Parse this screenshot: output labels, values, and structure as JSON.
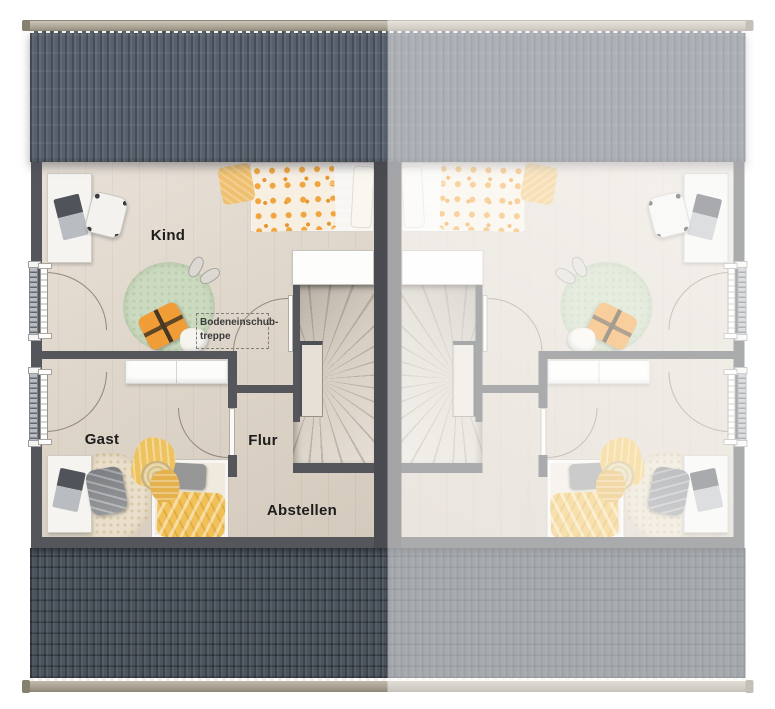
{
  "rooms": {
    "kind": "Kind",
    "gast": "Gast",
    "flur": "Flur",
    "abstellen": "Abstellen"
  },
  "attic": {
    "line1": "Bodeneinschub-",
    "line2": "treppe"
  },
  "colors": {
    "roof_top": "#57606c",
    "roof_bottom": "#4c545e",
    "gutter": "#b5ad9f",
    "wall": "#55565b",
    "party_wall": "#4a4b50",
    "floor": "#dfd4c6",
    "stair_wood": "#d6cec2",
    "accent_orange": "#f0a03c",
    "rug_green": "#ccdabf",
    "blanket_yellow": "#f2c158",
    "mirror_fade": "rgba(255,255,255,0.50)"
  }
}
